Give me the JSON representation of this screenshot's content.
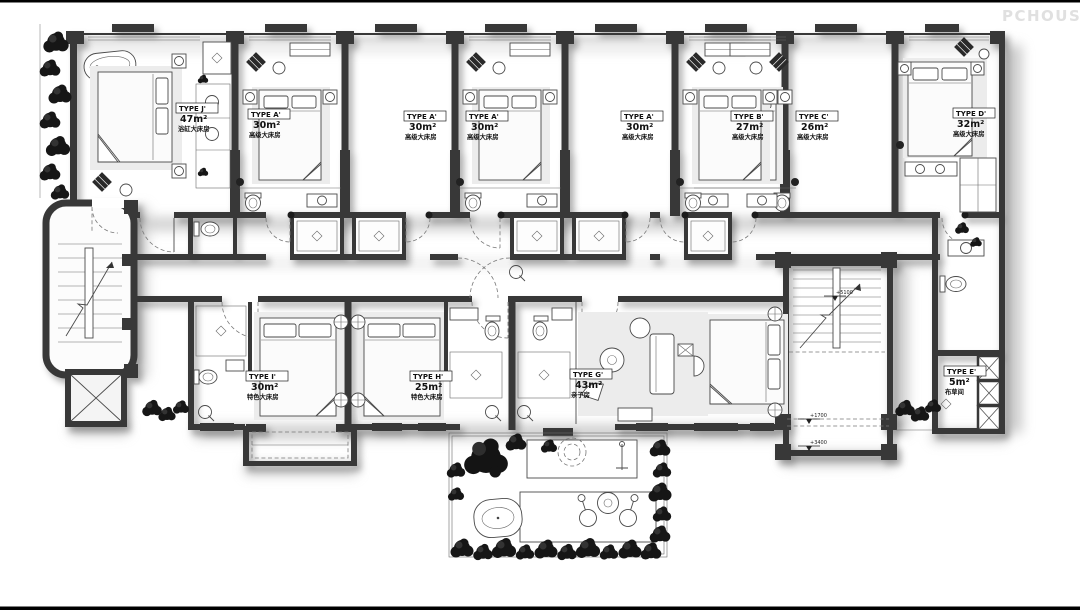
{
  "watermark": "PCHOUSE",
  "rooms": {
    "j": {
      "type": "TYPE J'",
      "area": "47m²",
      "name": "浴缸大床房"
    },
    "a1": {
      "type": "TYPE A'",
      "area": "30m²",
      "name": "高级大床房"
    },
    "a2": {
      "type": "TYPE A'",
      "area": "30m²",
      "name": "高级大床房"
    },
    "a3": {
      "type": "TYPE A'",
      "area": "30m²",
      "name": "高级大床房"
    },
    "a4": {
      "type": "TYPE A'",
      "area": "30m²",
      "name": "高级大床房"
    },
    "b": {
      "type": "TYPE B'",
      "area": "27m²",
      "name": "高级大床房"
    },
    "c": {
      "type": "TYPE C'",
      "area": "26m²",
      "name": "高级大床房"
    },
    "d": {
      "type": "TYPE D'",
      "area": "32m²",
      "name": "高级大床房"
    },
    "i": {
      "type": "TYPE I'",
      "area": "30m²",
      "name": "特色大床房"
    },
    "h": {
      "type": "TYPE H'",
      "area": "25m²",
      "name": "特色大床房"
    },
    "g": {
      "type": "TYPE G'",
      "area": "43m²",
      "name": "亲子房"
    },
    "e": {
      "type": "TYPE E'",
      "area": "5m²",
      "name": "布草间"
    }
  },
  "elevations": {
    "upper": "+5100",
    "mid": "+1700",
    "low": "+3400"
  }
}
